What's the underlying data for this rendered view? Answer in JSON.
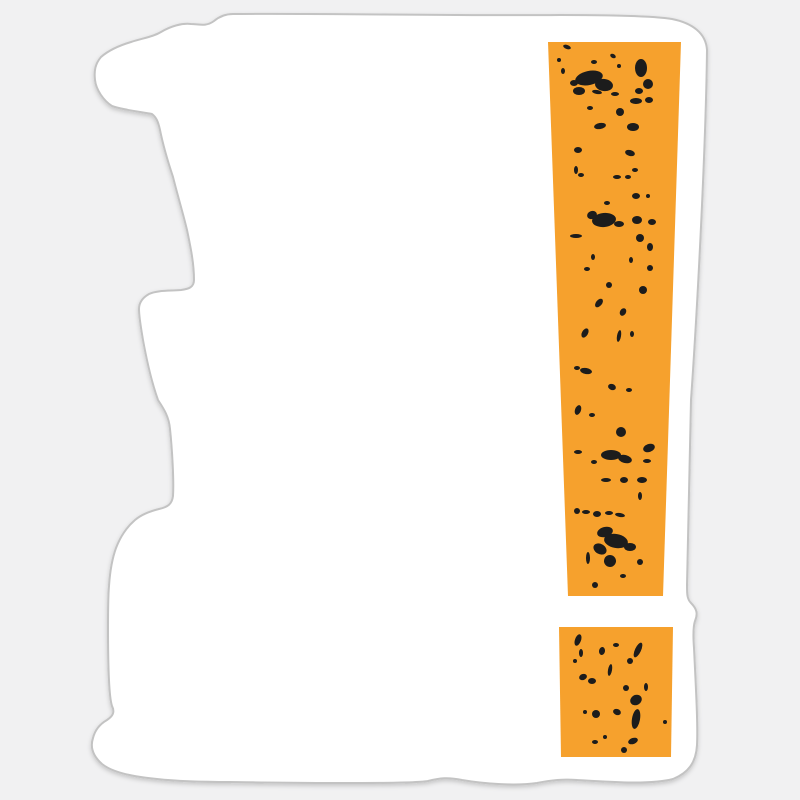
{
  "page": {
    "description": "Product mockup of a die-cut sticker with a distressed exclamation mark print",
    "background_color": "#f1f1f2"
  },
  "sticker": {
    "kind": "die-cut-sticker",
    "fill_color": "#ffffff",
    "edge_color": "#c3c3c3",
    "edge_width": 2,
    "shadow_color": "#000000",
    "shadow_opacity": 0.18,
    "outline_path": "M233 14 C320 13 450 16 560 15 C610 15 655 16 672 19 C692 23 706 33 707 50 C706 140 698 300 691 400 C689 470 688 540 687 585 C687 594 687 599 691 603 C697 609 698 614 695 621 C693 627 693 635 694 648 C696 690 698 725 697 745 C696 763 688 773 673 779 C650 785 610 782 577 780 C563 779 552 780 537 783 C516 786 485 784 462 780 C448 777 440 778 428 781 C410 784 300 783 230 782 C205 782 175 781 157 779 C135 777 113 773 102 764 C93 756 90 747 93 738 C95 730 100 724 107 720 C113 716 115 712 112 706 C109 697 108 660 108 628 C108 610 108 597 109 586 C110 571 112 559 116 548 C121 535 128 526 135 520 C142 514 151 511 159 509 C168 507 172 504 173 496 C174 480 172 448 170 429 C169 417 164 409 158 400 C153 386 147 362 143 340 C141 328 139 317 139 309 C139 303 142 298 149 294 C157 290 171 291 181 290 C189 289 194 287 194 280 C194 264 191 249 187 230 C183 213 178 197 173 177 C168 162 163 145 160 130 C158 121 156 117 152 114 C142 112 123 110 112 106 C104 101 96 90 95 80 C94 71 95 64 101 57 C109 50 121 45 131 42 C143 38 153 37 161 32 C171 26 182 23 191 24 C199 24 206 27 214 21 C220 16 226 14 233 14 Z"
  },
  "design": {
    "name": "grunge-exclamation-mark",
    "accent_color": "#f6a12d",
    "grunge_color": "#1c1c1c",
    "bar_points": "548,42 681,42 663,596 568,596",
    "dot_points": "559,627 673,627 671,757 561,757",
    "grunge_marks": [
      [
        567,
        47,
        4,
        2,
        20
      ],
      [
        559,
        60,
        2,
        2,
        0
      ],
      [
        563,
        71,
        2,
        3,
        0
      ],
      [
        594,
        62,
        3,
        2,
        0
      ],
      [
        613,
        56,
        3,
        2,
        30
      ],
      [
        619,
        66,
        2,
        2,
        0
      ],
      [
        589,
        78,
        14,
        7,
        -12
      ],
      [
        604,
        85,
        9,
        6,
        8
      ],
      [
        579,
        91,
        6,
        4,
        0
      ],
      [
        574,
        83,
        4,
        3,
        0
      ],
      [
        641,
        68,
        6,
        9,
        0
      ],
      [
        648,
        84,
        5,
        5,
        0
      ],
      [
        639,
        91,
        4,
        3,
        0
      ],
      [
        615,
        94,
        4,
        2,
        0
      ],
      [
        597,
        92,
        5,
        2,
        10
      ],
      [
        636,
        101,
        6,
        3,
        0
      ],
      [
        649,
        100,
        4,
        3,
        0
      ],
      [
        620,
        112,
        4,
        4,
        0
      ],
      [
        590,
        108,
        3,
        2,
        0
      ],
      [
        600,
        126,
        6,
        3,
        -10
      ],
      [
        633,
        127,
        6,
        4,
        0
      ],
      [
        578,
        150,
        4,
        3,
        0
      ],
      [
        630,
        153,
        5,
        3,
        15
      ],
      [
        635,
        170,
        3,
        2,
        0
      ],
      [
        576,
        170,
        2,
        4,
        0
      ],
      [
        617,
        177,
        4,
        2,
        0
      ],
      [
        628,
        177,
        3,
        2,
        0
      ],
      [
        581,
        175,
        3,
        2,
        0
      ],
      [
        607,
        203,
        3,
        2,
        0
      ],
      [
        636,
        196,
        4,
        3,
        0
      ],
      [
        648,
        196,
        2,
        2,
        0
      ],
      [
        604,
        220,
        12,
        7,
        -6
      ],
      [
        592,
        215,
        5,
        4,
        -20
      ],
      [
        619,
        224,
        5,
        3,
        0
      ],
      [
        637,
        220,
        5,
        4,
        0
      ],
      [
        652,
        222,
        4,
        3,
        0
      ],
      [
        576,
        236,
        6,
        2,
        0
      ],
      [
        640,
        238,
        4,
        4,
        0
      ],
      [
        650,
        247,
        3,
        4,
        0
      ],
      [
        593,
        257,
        2,
        3,
        0
      ],
      [
        631,
        260,
        2,
        3,
        0
      ],
      [
        587,
        269,
        3,
        2,
        0
      ],
      [
        650,
        268,
        3,
        3,
        0
      ],
      [
        609,
        285,
        3,
        3,
        0
      ],
      [
        643,
        290,
        4,
        4,
        0
      ],
      [
        599,
        303,
        3,
        5,
        40
      ],
      [
        623,
        312,
        3,
        4,
        30
      ],
      [
        585,
        333,
        3,
        5,
        30
      ],
      [
        619,
        336,
        2,
        6,
        10
      ],
      [
        632,
        334,
        2,
        3,
        0
      ],
      [
        586,
        371,
        6,
        3,
        10
      ],
      [
        577,
        368,
        3,
        2,
        0
      ],
      [
        612,
        387,
        4,
        3,
        20
      ],
      [
        629,
        390,
        3,
        2,
        0
      ],
      [
        578,
        410,
        3,
        5,
        20
      ],
      [
        592,
        415,
        3,
        2,
        0
      ],
      [
        621,
        432,
        5,
        5,
        0
      ],
      [
        649,
        448,
        6,
        4,
        -20
      ],
      [
        611,
        455,
        10,
        5,
        0
      ],
      [
        625,
        459,
        7,
        4,
        15
      ],
      [
        578,
        452,
        4,
        2,
        0
      ],
      [
        594,
        462,
        3,
        2,
        0
      ],
      [
        647,
        461,
        4,
        2,
        0
      ],
      [
        606,
        480,
        5,
        2,
        0
      ],
      [
        624,
        480,
        4,
        3,
        0
      ],
      [
        642,
        480,
        5,
        3,
        0
      ],
      [
        640,
        496,
        2,
        4,
        0
      ],
      [
        577,
        511,
        3,
        3,
        0
      ],
      [
        586,
        512,
        4,
        2,
        0
      ],
      [
        597,
        514,
        4,
        3,
        0
      ],
      [
        609,
        513,
        4,
        2,
        0
      ],
      [
        620,
        515,
        5,
        2,
        10
      ],
      [
        605,
        532,
        8,
        5,
        -15
      ],
      [
        616,
        541,
        12,
        7,
        10
      ],
      [
        600,
        549,
        7,
        5,
        30
      ],
      [
        630,
        547,
        6,
        4,
        0
      ],
      [
        588,
        558,
        2,
        6,
        0
      ],
      [
        610,
        561,
        6,
        6,
        20
      ],
      [
        640,
        562,
        3,
        3,
        0
      ],
      [
        623,
        576,
        3,
        2,
        0
      ],
      [
        595,
        585,
        3,
        3,
        0
      ],
      [
        578,
        640,
        3,
        6,
        20
      ],
      [
        581,
        653,
        2,
        4,
        0
      ],
      [
        575,
        661,
        2,
        2,
        0
      ],
      [
        602,
        651,
        3,
        4,
        10
      ],
      [
        616,
        645,
        3,
        2,
        0
      ],
      [
        638,
        650,
        3,
        8,
        25
      ],
      [
        630,
        661,
        3,
        3,
        0
      ],
      [
        610,
        670,
        2,
        6,
        10
      ],
      [
        583,
        677,
        4,
        3,
        -20
      ],
      [
        592,
        681,
        4,
        3,
        0
      ],
      [
        646,
        687,
        2,
        4,
        0
      ],
      [
        626,
        688,
        3,
        3,
        0
      ],
      [
        636,
        700,
        6,
        5,
        -30
      ],
      [
        596,
        714,
        4,
        4,
        0
      ],
      [
        585,
        712,
        2,
        2,
        0
      ],
      [
        617,
        712,
        4,
        3,
        20
      ],
      [
        636,
        719,
        4,
        10,
        10
      ],
      [
        665,
        722,
        2,
        2,
        0
      ],
      [
        595,
        742,
        3,
        2,
        0
      ],
      [
        633,
        741,
        5,
        3,
        -20
      ],
      [
        624,
        750,
        3,
        3,
        0
      ],
      [
        605,
        737,
        2,
        2,
        0
      ]
    ]
  }
}
